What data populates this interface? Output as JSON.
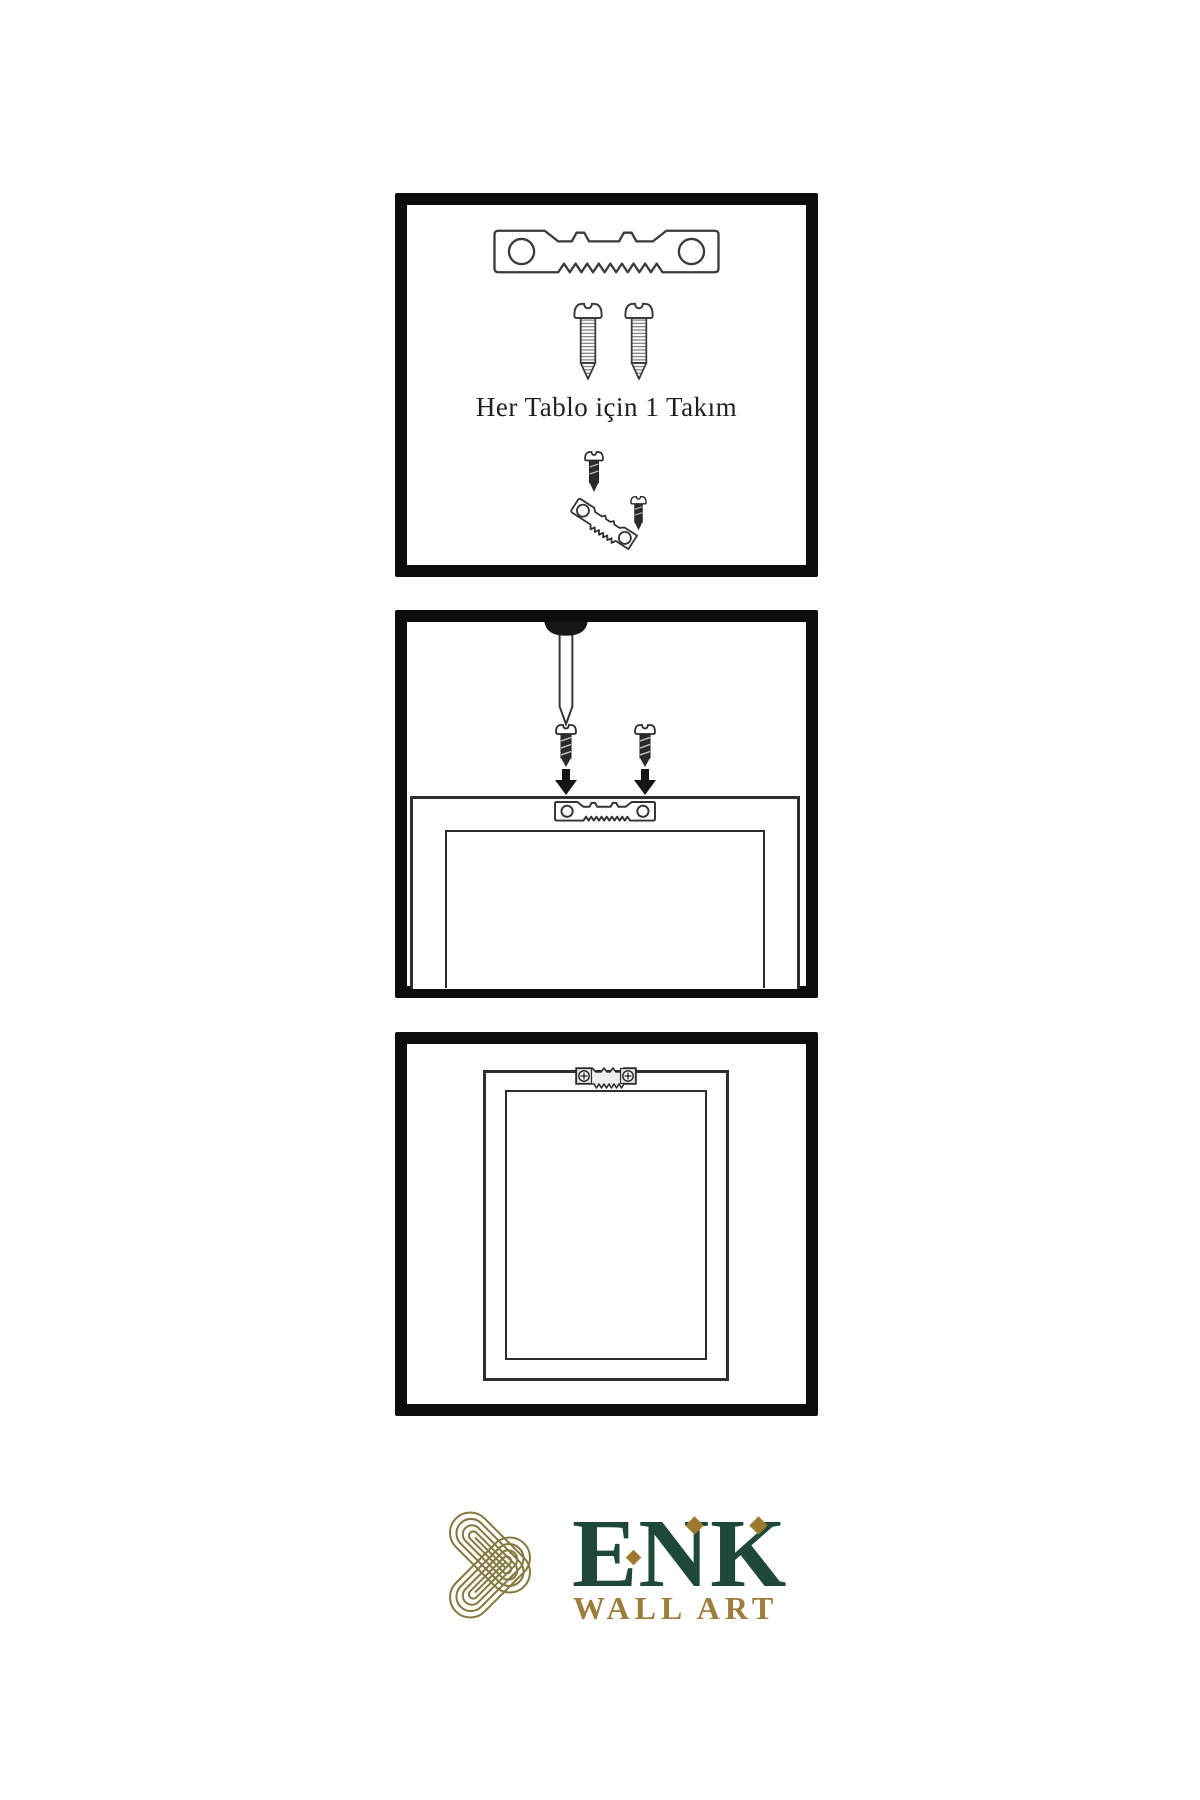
{
  "canvas": {
    "width": 1200,
    "height": 1800,
    "background": "#ffffff"
  },
  "colors": {
    "panel_border": "#0d0d0d",
    "line": "#3a3a3a",
    "dark_fill": "#262626",
    "brand_green": "#1e4838",
    "gold": "#9d7d3c",
    "knot_gold": "#85793f"
  },
  "panel1": {
    "name": "hardware-kit",
    "caption": "Her Tablo için 1 Takım",
    "icons": [
      "sawtooth-hanger",
      "screw",
      "screw",
      "mini-dark-screw",
      "tilted-sawtooth-hanger",
      "mini-dark-screw"
    ]
  },
  "panel2": {
    "name": "mounting-steps",
    "icons": [
      "wall-nail",
      "dark-screw",
      "dark-screw",
      "down-arrow",
      "down-arrow",
      "frame-back-outline",
      "sawtooth-hanger-small"
    ]
  },
  "panel3": {
    "name": "hanging-result",
    "icons": [
      "picture-frame",
      "mounted-sawtooth-hanger-with-screws"
    ]
  },
  "logo": {
    "brand": "ENK",
    "subtitle": "WALL ART",
    "knot_icon": "interlaced-knot",
    "diamond_accents": 3
  }
}
